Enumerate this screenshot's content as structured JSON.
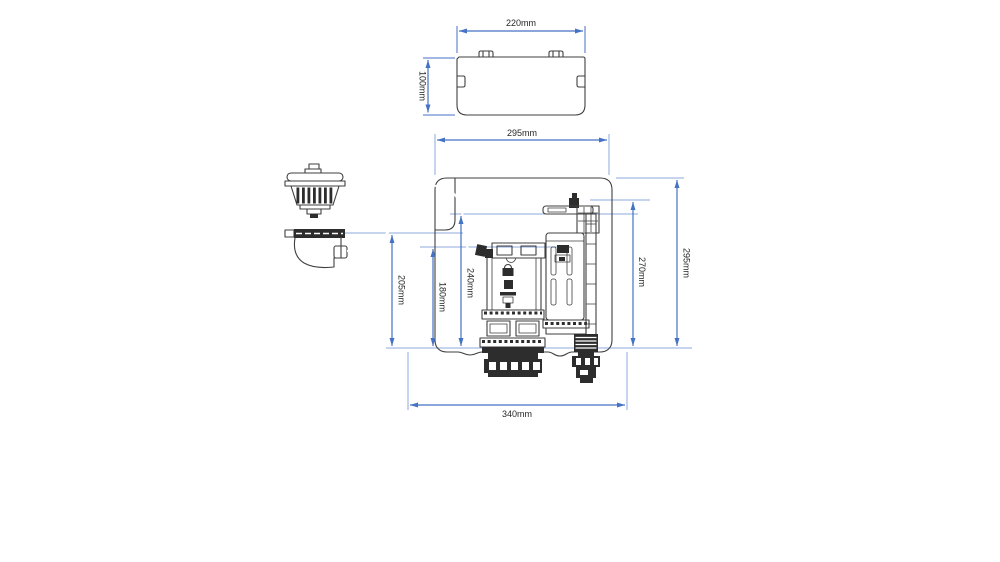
{
  "figure": {
    "type": "technical-dimension-drawing",
    "subject": "concealed cistern tank with pneumatic flush button, flush valve, fill valve and lid",
    "units": "mm"
  },
  "colors": {
    "dimension_line": "#4472C4",
    "extension_line": "#8FAADC",
    "drawing_ink": "#3F3F3F",
    "background": "#FFFFFF"
  },
  "lid_view": {
    "width_label": "220mm",
    "height_label": "100mm"
  },
  "tank_view": {
    "top_width_label": "295mm",
    "overall_height_label": "295mm",
    "fill_valve_height_label": "270mm",
    "button_housing_height_label": "205mm",
    "flush_valve_height_label": "180mm",
    "cable_entry_height_label": "240mm",
    "bottom_width_label": "340mm"
  }
}
